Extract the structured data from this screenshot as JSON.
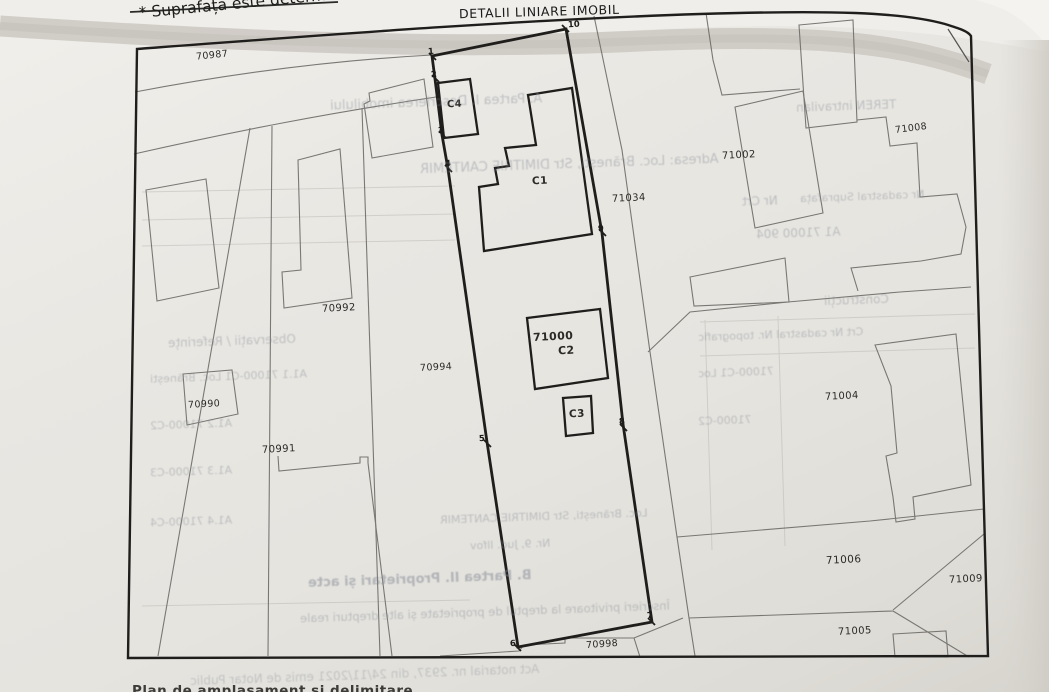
{
  "page": {
    "note": "* Suprafața este determinată",
    "map_title": "DETALII LINIARE IMOBIL",
    "bottom_cut_text": "Plan de amplasament și delimitare"
  },
  "colors": {
    "paper": "#e9e7e2",
    "curl_shadow": "#cbc7c1",
    "bold_line": "#1f1e1c",
    "thin_line": "#6e6c68",
    "bleed_text": "#818895"
  },
  "map": {
    "labels": [
      {
        "text": "70987"
      },
      {
        "text": "70992"
      },
      {
        "text": "70990"
      },
      {
        "text": "70991"
      },
      {
        "text": "70994"
      },
      {
        "text": "71000"
      },
      {
        "text": "C2"
      },
      {
        "text": "C3"
      },
      {
        "text": "C1"
      },
      {
        "text": "C4"
      },
      {
        "text": "71034"
      },
      {
        "text": "71002"
      },
      {
        "text": "71008"
      },
      {
        "text": "71004"
      },
      {
        "text": "71006"
      },
      {
        "text": "71009"
      },
      {
        "text": "71005"
      },
      {
        "text": "70998"
      }
    ],
    "vertices": [
      {
        "text": "1"
      },
      {
        "text": "2"
      },
      {
        "text": "3"
      },
      {
        "text": "4"
      },
      {
        "text": "5"
      },
      {
        "text": "6"
      },
      {
        "text": "7"
      },
      {
        "text": "8"
      },
      {
        "text": "9"
      },
      {
        "text": "10"
      }
    ]
  },
  "bleedthrough": [
    {
      "text": "A. Partea I. Descrierea imobilului"
    },
    {
      "text": "TEREN intravilan"
    },
    {
      "text": "Adresa: Loc. Brănești, Str DIMITRIE CANTEMIR"
    },
    {
      "text": "Nr Crt"
    },
    {
      "text": "Nr cadastral    Suprafața"
    },
    {
      "text": "A1    71000    904"
    },
    {
      "text": "Construcții"
    },
    {
      "text": "Observații / Referințe"
    },
    {
      "text": "Crt    Nr cadastral Nr. topografic"
    },
    {
      "text": "A1.1   71000-C1   Loc. Brănești"
    },
    {
      "text": "71000-C1   Loc"
    },
    {
      "text": "A1.2   71000-C2"
    },
    {
      "text": "71000-C2"
    },
    {
      "text": "A1.3   71000-C3"
    },
    {
      "text": "A1.4   71000-C4"
    },
    {
      "text": "Loc. Brănești, Str DIMITRIE CANTEMIR"
    },
    {
      "text": "Nr. 9, Jud. Ilfov"
    },
    {
      "text": "B. Partea II. Proprietari și acte"
    },
    {
      "text": "Înscrieri privitoare la dreptul de proprietate și alte drepturi reale"
    },
    {
      "text": "Act notarial nr. 2937, din 24/11/2021 emis de Notar Public"
    }
  ]
}
